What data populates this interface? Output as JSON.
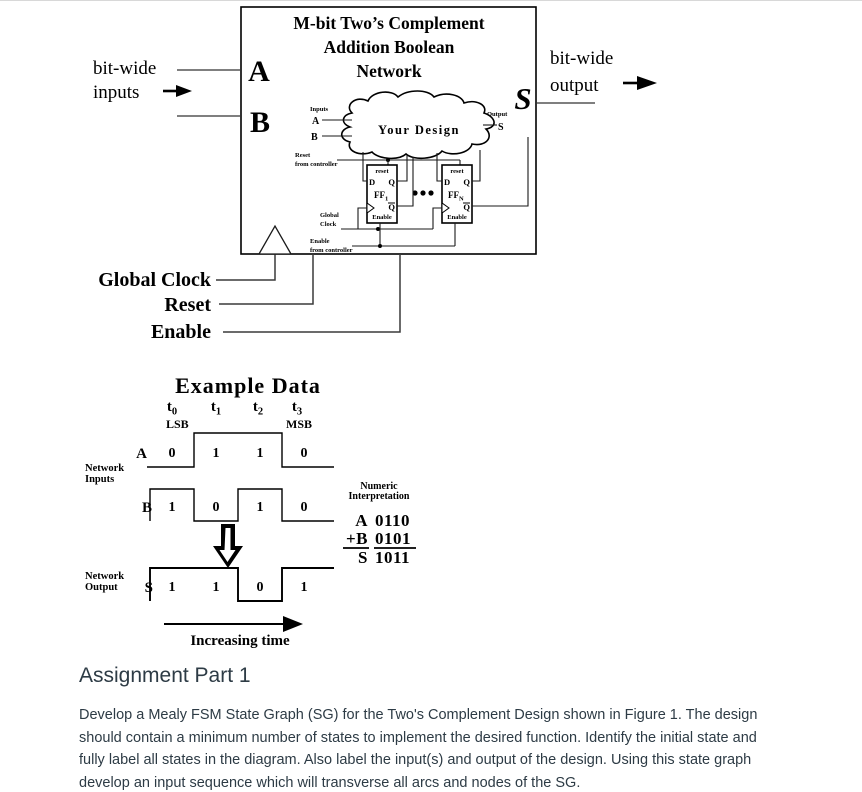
{
  "colors": {
    "figure_ink": "#000000",
    "wire_gray": "#3a3a3a",
    "body_text": "#2d3b45",
    "background": "#ffffff"
  },
  "block_diagram": {
    "title_line1": "M-bit Two’s Complement",
    "title_line2": "Addition Boolean",
    "title_line3": "Network",
    "port_a": "A",
    "port_b": "B",
    "port_s": "S",
    "left_caption_line1": "bit-wide",
    "left_caption_line2": "inputs",
    "right_caption_line1": "bit-wide",
    "right_caption_line2": "output",
    "control_global_clock": "Global Clock",
    "control_reset": "Reset",
    "control_enable": "Enable",
    "inner": {
      "inputs_caption": "Inputs",
      "input_a": "A",
      "input_b": "B",
      "output_caption": "Output",
      "output_s": "S",
      "cloud_caption": "Your Design",
      "reset_caption_line1": "Reset",
      "reset_caption_line2": "from controller",
      "clock_caption_line1": "Global",
      "clock_caption_line2": "Clock",
      "enable_caption_line1": "Enable",
      "enable_caption_line2": "from controller",
      "ff_reset": "reset",
      "ff_d": "D",
      "ff_q": "Q",
      "ff_qbar": "Q",
      "ff_name": "FF",
      "ff1_sub": "1",
      "ffn_sub": "N",
      "ff_enable": "Enable"
    }
  },
  "timing": {
    "title": "Example Data",
    "time_labels": [
      {
        "base": "t",
        "sub": "0"
      },
      {
        "base": "t",
        "sub": "1"
      },
      {
        "base": "t",
        "sub": "2"
      },
      {
        "base": "t",
        "sub": "3"
      }
    ],
    "lsb": "LSB",
    "msb": "MSB",
    "inputs_caption_line1": "Network",
    "inputs_caption_line2": "Inputs",
    "output_caption_line1": "Network",
    "output_caption_line2": "Output",
    "columns": [
      150,
      194,
      238,
      282,
      326
    ],
    "signals": [
      {
        "name": "A",
        "values": [
          0,
          1,
          1,
          0
        ]
      },
      {
        "name": "B",
        "values": [
          1,
          0,
          1,
          0
        ]
      },
      {
        "name": "S",
        "values": [
          1,
          1,
          0,
          1
        ]
      }
    ],
    "increasing_time": "Increasing time",
    "numeric": {
      "title_line1": "Numeric",
      "title_line2": "Interpretation",
      "rows": [
        {
          "label": "A",
          "value": "0110"
        },
        {
          "label": "+B",
          "value": "0101"
        },
        {
          "label": "S",
          "value": "1011"
        }
      ]
    }
  },
  "assignment": {
    "heading": "Assignment Part 1",
    "body": "Develop a Mealy FSM State Graph (SG) for the Two's Complement Design shown in Figure 1. The design should contain a minimum number of states to implement the desired function. Identify the initial state and fully label all states in the diagram. Also label the input(s) and output of the design. Using this state graph develop an input sequence which will transverse all arcs and nodes of the SG."
  }
}
